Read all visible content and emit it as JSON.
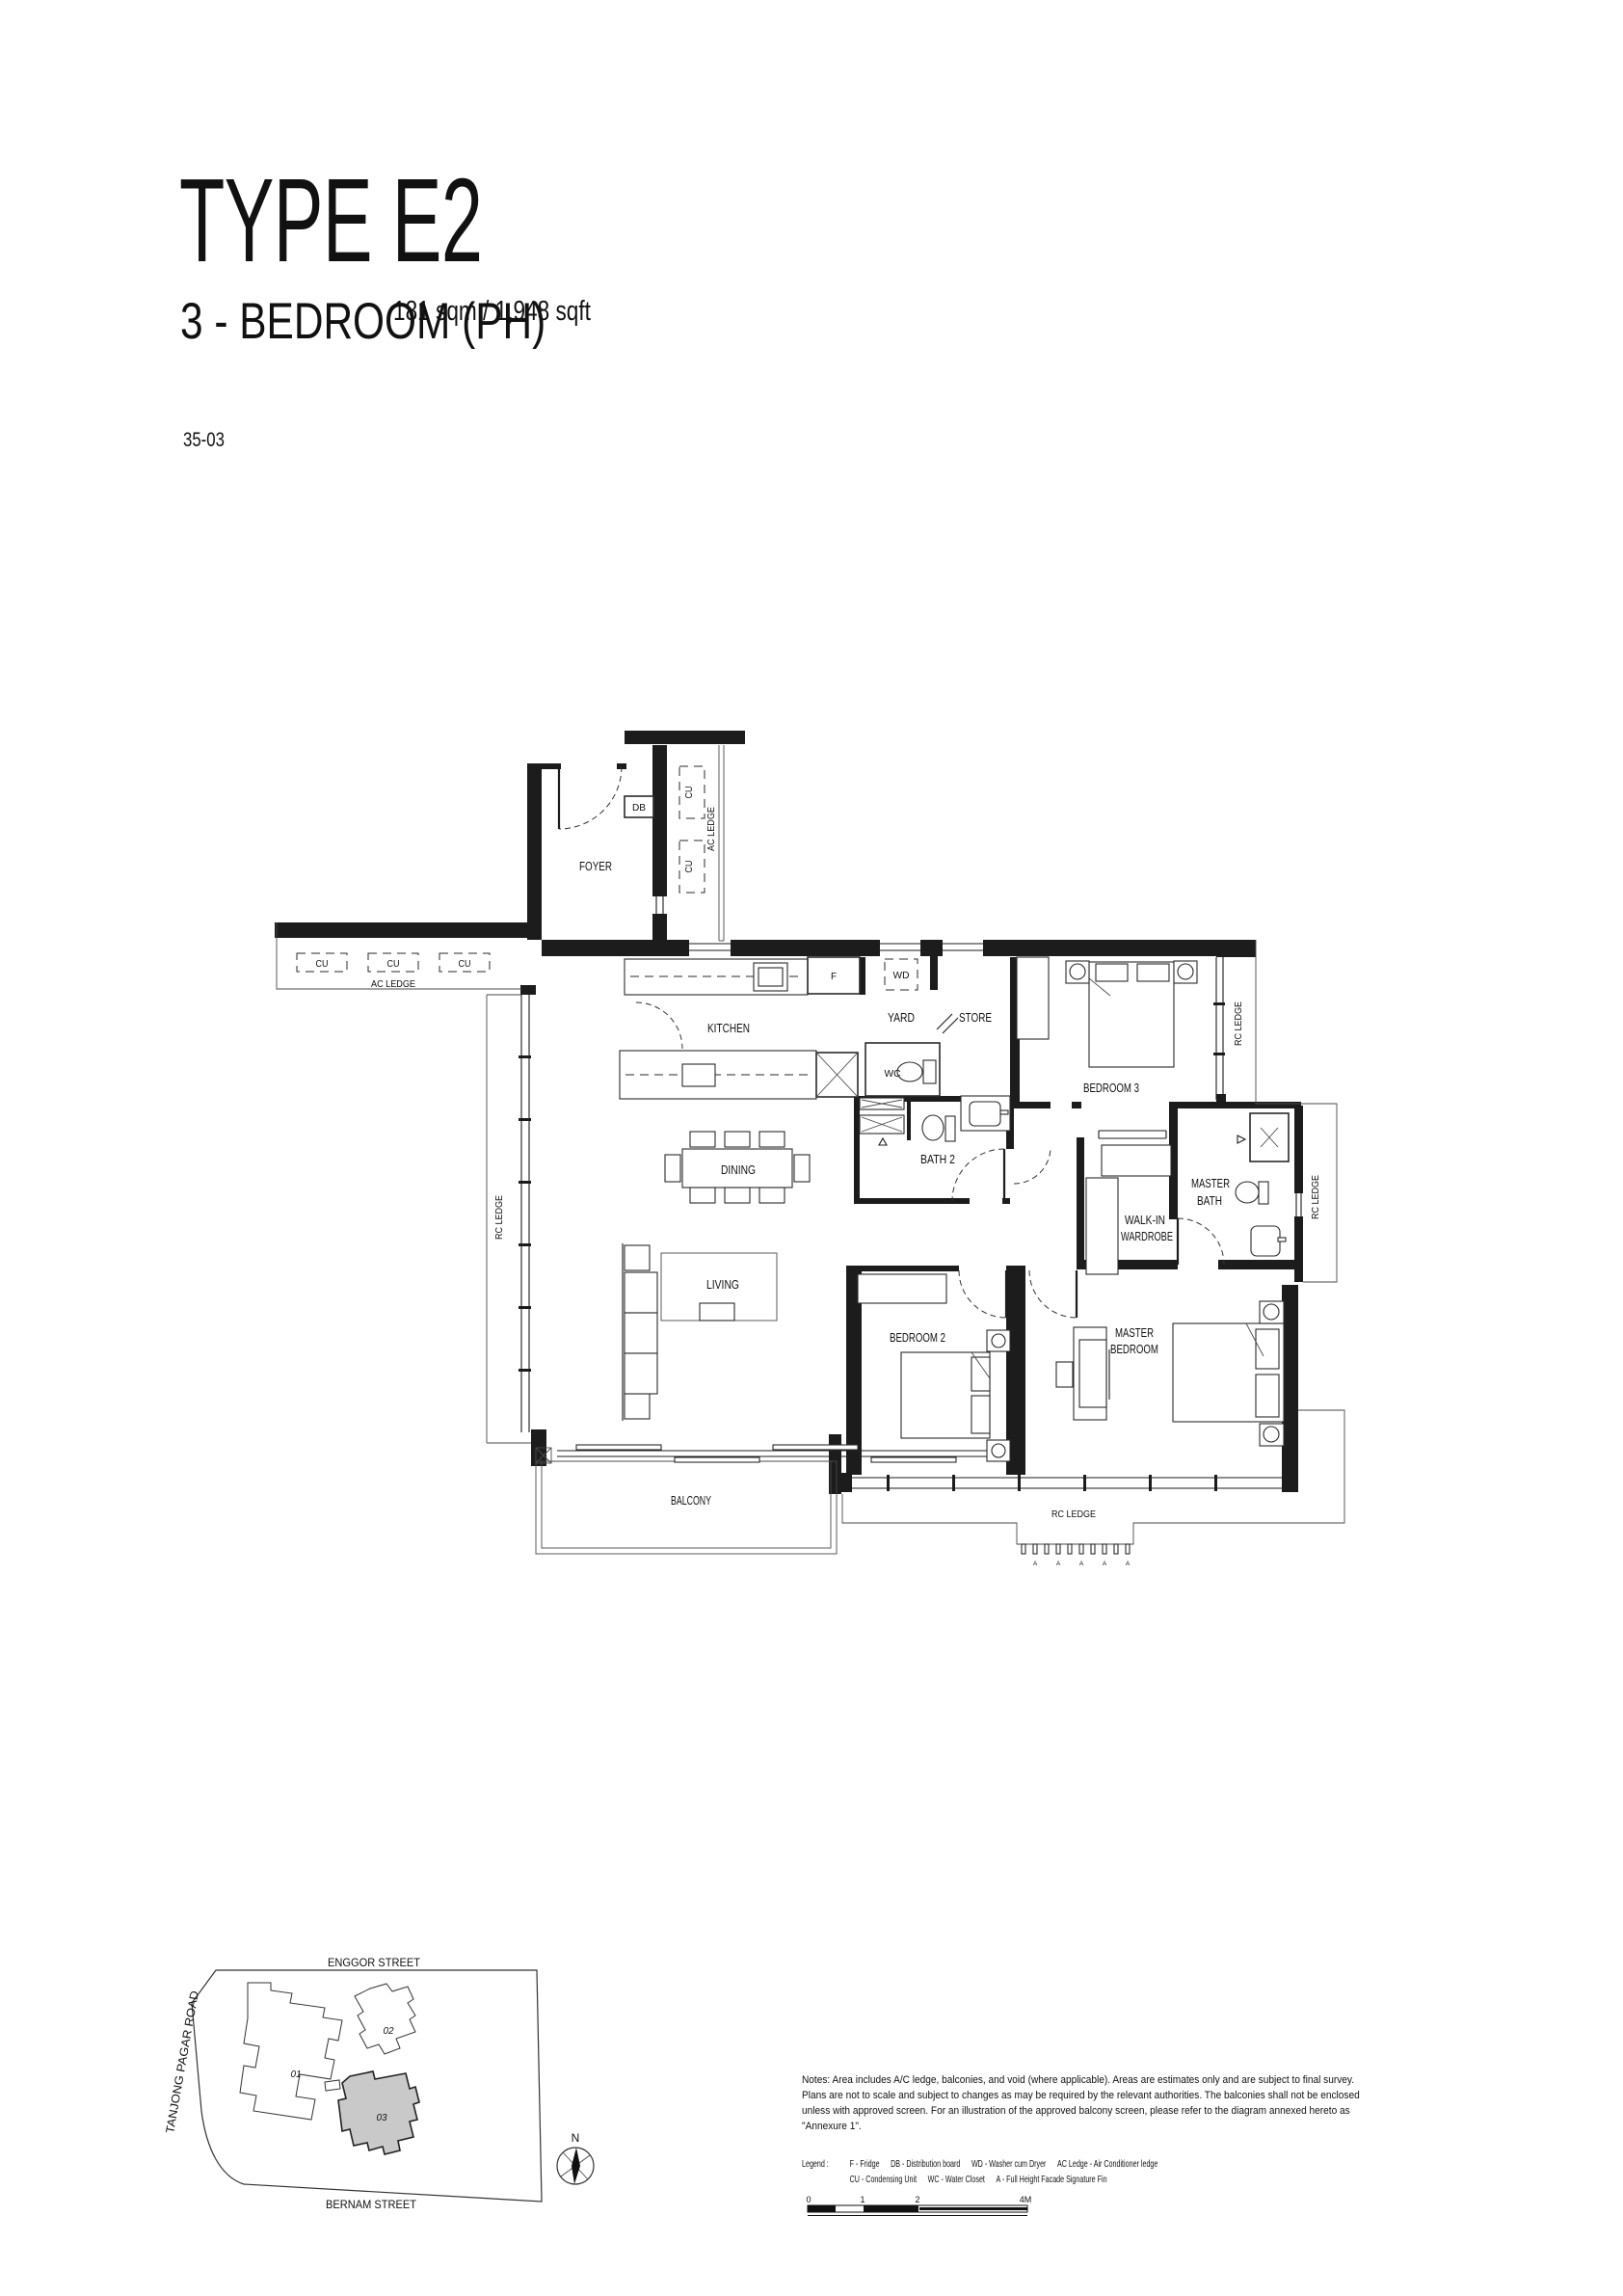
{
  "header": {
    "title": "TYPE E2",
    "subtitle": "3 - BEDROOM (PH)",
    "area": "181 sqm / 1,948 sqft",
    "unit": "35-03"
  },
  "plan": {
    "rooms": {
      "foyer": "FOYER",
      "kitchen": "KITCHEN",
      "yard": "YARD",
      "store": "STORE",
      "bedroom3": "BEDROOM 3",
      "dining": "DINING",
      "bath2": "BATH 2",
      "walkin_l1": "WALK-IN",
      "walkin_l2": "WARDROBE",
      "masterbath_l1": "MASTER",
      "masterbath_l2": "BATH",
      "living": "LIVING",
      "bedroom2": "BEDROOM 2",
      "master_l1": "MASTER",
      "master_l2": "BEDROOM",
      "balcony": "BALCONY"
    },
    "ledges": {
      "ac": "AC LEDGE",
      "rc": "RC LEDGE"
    },
    "tags": {
      "cu": "CU",
      "db": "DB",
      "fridge": "F",
      "wd": "WD",
      "wc": "WC",
      "fin": "A"
    }
  },
  "siteplan": {
    "streets": {
      "top": "ENGGOR STREET",
      "left": "TANJONG PAGAR ROAD",
      "bottom": "BERNAM STREET"
    },
    "blocks": {
      "b1": "01",
      "b2": "02",
      "b3": "03"
    },
    "north": "N",
    "highlight_color": "#c9c9c9"
  },
  "notes": {
    "lines": [
      "Notes: Area includes A/C ledge, balconies, and void (where applicable). Areas are estimates only and are subject to final survey.",
      "Plans are not to scale and subject to changes as may be required by the relevant authorities. The balconies shall not be enclosed",
      "unless with approved screen. For an illustration of the approved balcony screen, please refer to the diagram annexed hereto as",
      "\"Annexure 1\"."
    ]
  },
  "legend": {
    "label": "Legend :",
    "row1": [
      "F - Fridge",
      "DB - Distribution board",
      "WD - Washer cum Dryer",
      "AC Ledge - Air Conditioner ledge"
    ],
    "row2": [
      "CU - Condensing Unit",
      "WC - Water Closet",
      "A - Full Height Facade Signature Fin"
    ]
  },
  "scalebar": {
    "ticks": [
      "0",
      "1",
      "2",
      "4M"
    ]
  }
}
